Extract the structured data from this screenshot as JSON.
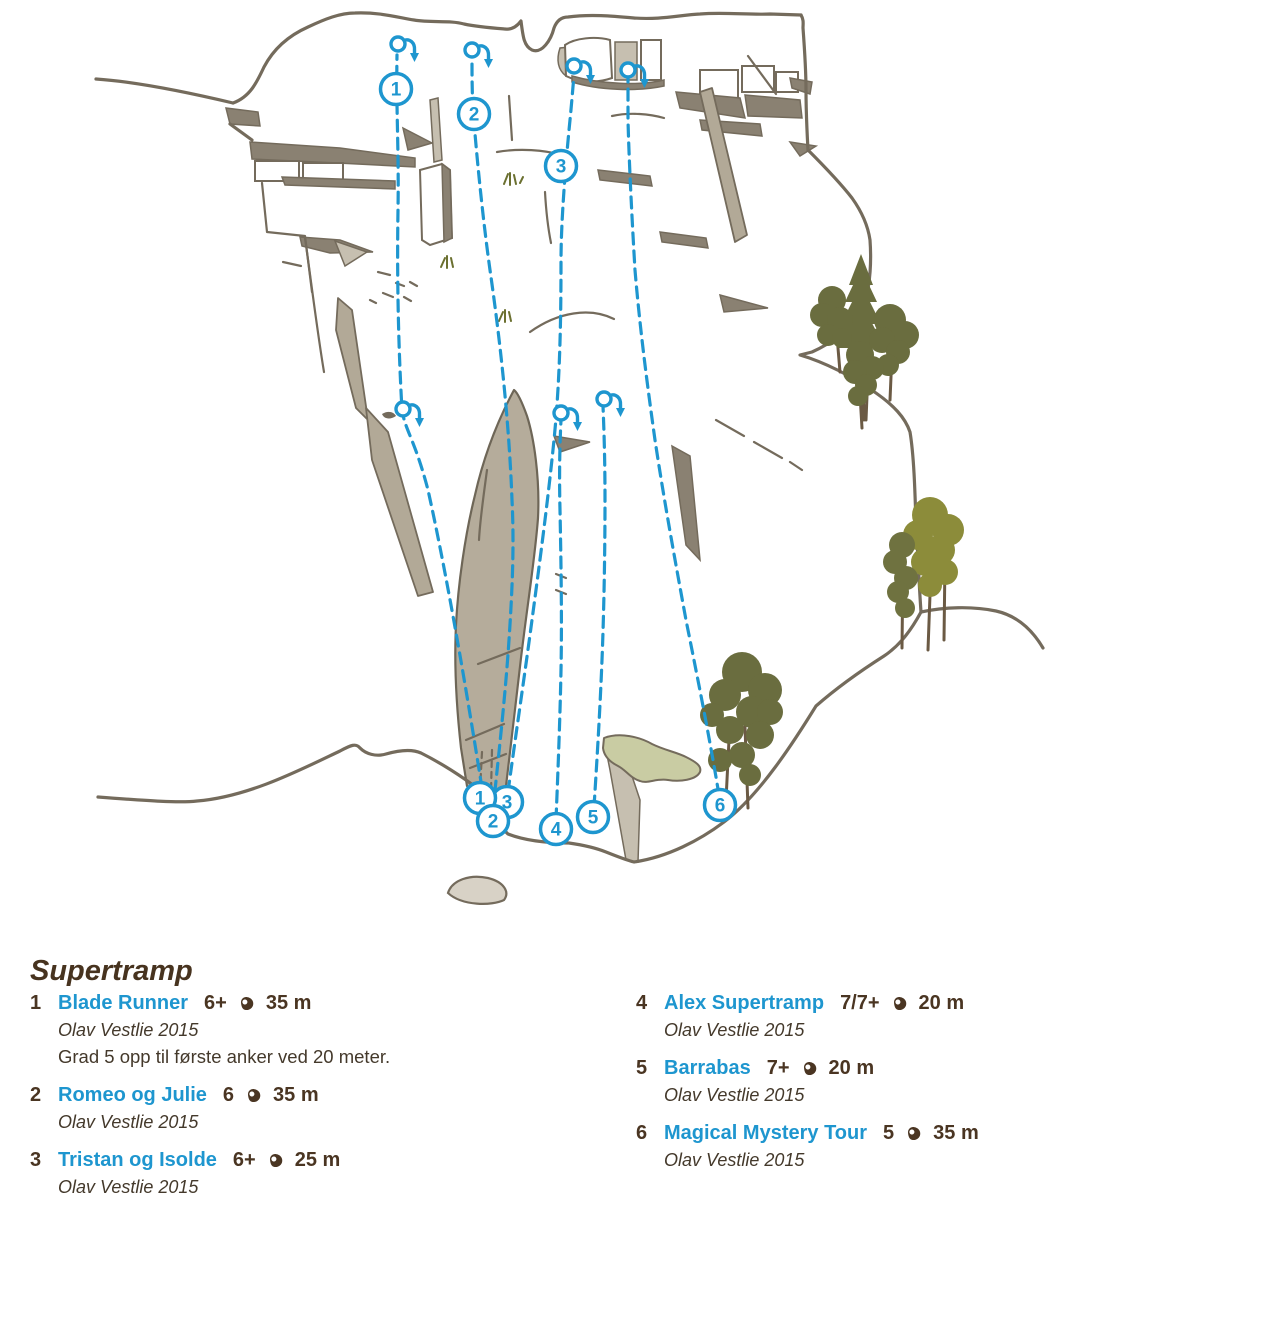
{
  "page": {
    "heading": "Supertramp"
  },
  "colors": {
    "route_blue": "#1E96CF",
    "text_brown": "#4A3522",
    "credit_brown": "#44392B",
    "rock_outline": "#746B5C",
    "rock_fill": "#B2A997",
    "rock_shadow": "#8A8172",
    "scree_patch": "#C9CCA3",
    "tree_dark_olive": "#6A6D3F",
    "tree_light_olive": "#8C8C3A"
  },
  "routes": [
    {
      "number": "1",
      "name": "Blade Runner",
      "grade": "6+",
      "length": "35 m",
      "credit": "Olav Vestlie 2015",
      "note": "Grad 5 opp til første anker ved 20 meter.",
      "column": 0
    },
    {
      "number": "2",
      "name": "Romeo og Julie",
      "grade": "6",
      "length": "35 m",
      "credit": "Olav Vestlie 2015",
      "note": "",
      "column": 0
    },
    {
      "number": "3",
      "name": "Tristan og Isolde",
      "grade": "6+",
      "length": "25 m",
      "credit": "Olav Vestlie 2015",
      "note": "",
      "column": 0
    },
    {
      "number": "4",
      "name": "Alex Supertramp",
      "grade": "7/7+",
      "length": "20 m",
      "credit": "Olav Vestlie 2015",
      "note": "",
      "column": 1
    },
    {
      "number": "5",
      "name": "Barrabas",
      "grade": "7+",
      "length": "20 m",
      "credit": "Olav Vestlie 2015",
      "note": "",
      "column": 1
    },
    {
      "number": "6",
      "name": "Magical Mystery Tour",
      "grade": "5",
      "length": "35 m",
      "credit": "Olav Vestlie 2015",
      "note": "",
      "column": 1
    }
  ],
  "topo": {
    "markers": [
      {
        "n": "1",
        "x": 396,
        "y": 89
      },
      {
        "n": "2",
        "x": 474,
        "y": 114
      },
      {
        "n": "3",
        "x": 561,
        "y": 166
      },
      {
        "n": "3",
        "x": 507,
        "y": 802
      },
      {
        "n": "1",
        "x": 480,
        "y": 798
      },
      {
        "n": "2",
        "x": 493,
        "y": 821
      },
      {
        "n": "4",
        "x": 556,
        "y": 829
      },
      {
        "n": "5",
        "x": 593,
        "y": 817
      },
      {
        "n": "6",
        "x": 720,
        "y": 805
      }
    ],
    "anchors": [
      {
        "x": 398,
        "y": 44
      },
      {
        "x": 472,
        "y": 50
      },
      {
        "x": 574,
        "y": 66
      },
      {
        "x": 628,
        "y": 70
      },
      {
        "x": 403,
        "y": 409
      },
      {
        "x": 561,
        "y": 413
      },
      {
        "x": 604,
        "y": 399
      }
    ]
  }
}
